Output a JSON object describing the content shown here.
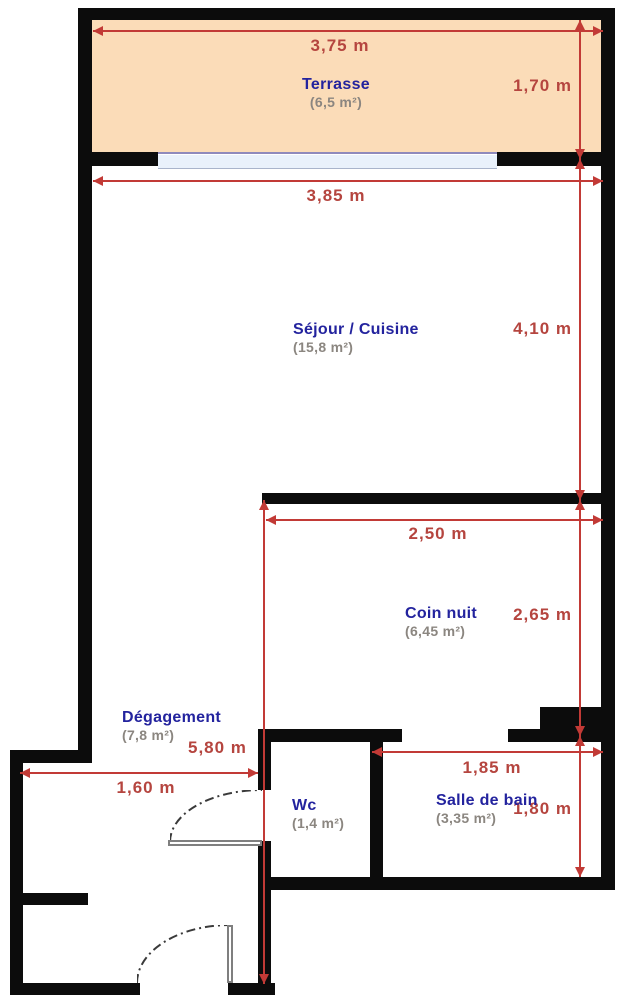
{
  "plan": {
    "type": "apartment-floor-plan",
    "colors": {
      "wall": "#0c0c0c",
      "dimension_line": "#c23a36",
      "dimension_text": "#b5453f",
      "room_name_text": "#23239e",
      "room_area_text": "#8b8680",
      "terrace_fill": "#fbdcb8",
      "window_fill": "#e9f1fb",
      "window_line": "#8f8abc"
    },
    "rooms": [
      {
        "id": "terrasse",
        "name": "Terrasse",
        "area": "(6,5 m²)"
      },
      {
        "id": "sejour-cuisine",
        "name": "Séjour / Cuisine",
        "area": "(15,8 m²)"
      },
      {
        "id": "coin-nuit",
        "name": "Coin nuit",
        "area": "(6,45 m²)"
      },
      {
        "id": "degagement",
        "name": "Dégagement",
        "area": "(7,8 m²)"
      },
      {
        "id": "wc",
        "name": "Wc",
        "area": "(1,4 m²)"
      },
      {
        "id": "salle-de-bain",
        "name": "Salle de bain",
        "area": "(3,35 m²)"
      }
    ],
    "dimensions": [
      {
        "id": "terrasse-width",
        "label": "3,75 m"
      },
      {
        "id": "terrasse-depth",
        "label": "1,70 m"
      },
      {
        "id": "sejour-width",
        "label": "3,85 m"
      },
      {
        "id": "sejour-depth",
        "label": "4,10 m"
      },
      {
        "id": "coin-nuit-width",
        "label": "2,50 m"
      },
      {
        "id": "coin-nuit-depth",
        "label": "2,65 m"
      },
      {
        "id": "degagement-length",
        "label": "5,80 m"
      },
      {
        "id": "entry-width",
        "label": "1,60 m"
      },
      {
        "id": "salle-de-bain-width",
        "label": "1,85 m"
      },
      {
        "id": "salle-de-bain-depth",
        "label": "1,80 m"
      }
    ]
  }
}
